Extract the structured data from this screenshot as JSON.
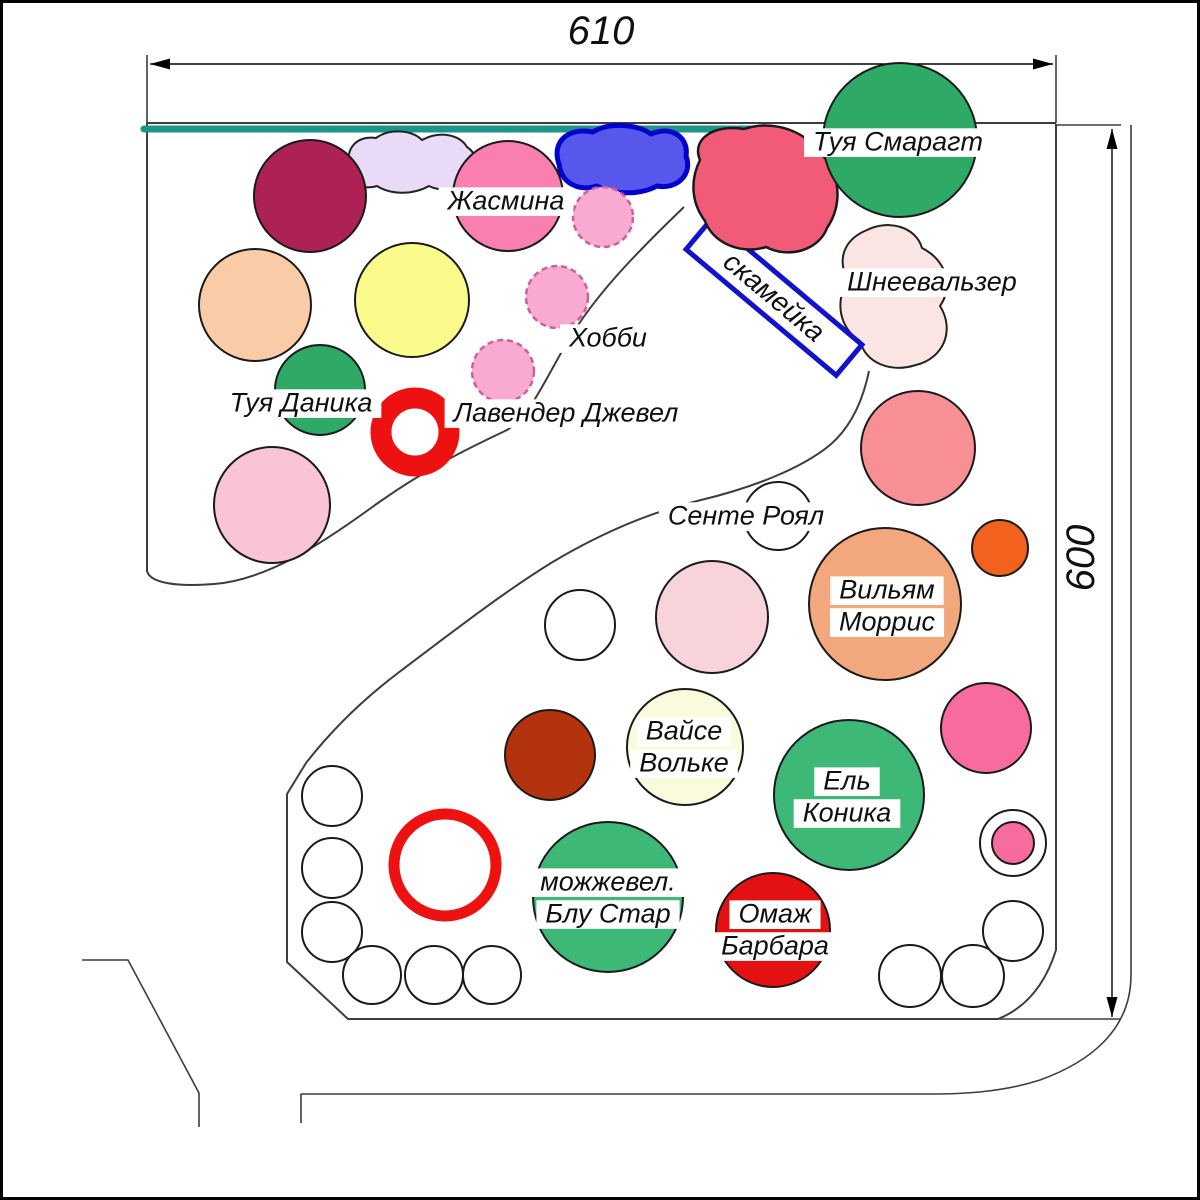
{
  "title": "Garden planting plan",
  "dim_top": {
    "label": "610",
    "line": {
      "x1": 150,
      "y1": 64,
      "x2": 1053,
      "y2": 64
    },
    "text_pos": {
      "x": 601,
      "y": 30
    },
    "rot": 0
  },
  "dim_right": {
    "label": "600",
    "line": {
      "x1": 1112,
      "y1": 129,
      "x2": 1112,
      "y2": 1017
    },
    "text_pos": {
      "x": 1080,
      "y": 558
    },
    "rot": -90
  },
  "aux_lines": [
    {
      "name": "extension-610-left",
      "d": "M147,55 V123"
    },
    {
      "name": "extension-610-right",
      "d": "M1056,55 V123"
    },
    {
      "name": "extension-600-top",
      "d": "M1057,125 H1121"
    },
    {
      "name": "extension-600-bottom",
      "d": "M995,1019 H1121"
    },
    {
      "name": "road-left",
      "d": "M82,960 H128 L199,1093 V1127"
    },
    {
      "name": "road-bottom-right",
      "d": "M1131,125 V975 C1131,1030 1090,1062 1040,1080 C1000,1093 958,1094 930,1094 H301 V1123"
    }
  ],
  "boundary": [
    {
      "name": "bed-upper-outline",
      "d": "M1056,123 H147 V571 C150,583 176,587 214,584 C266,580 320,545 371,508 C423,470 471,447 505,431 C529,419 544,381 568,341 C594,297 632,257 684,207"
    },
    {
      "name": "bed-lower-outline",
      "d": "M869,371 C863,400 851,427 830,445 C801,469 751,488 701,500 C650,512 601,533 551,563 C501,594 451,633 398,673 C361,701 331,731 306,763 L287,794 V962 L348,1019 H998 C1028,1007 1046,982 1056,950 V124"
    }
  ],
  "fence": {
    "name": "fence-teal",
    "d": "M144,129 H757",
    "color": "#1A968C",
    "width": 7
  },
  "blobs": [
    {
      "name": "lavender-blob",
      "layer": "under",
      "fill": "#E9DAF8",
      "stroke": "#222222",
      "sw": 2,
      "d": "M350,168 C344,149 357,135 376,138 C390,128 412,130 422,140 C440,130 460,135 467,147 C478,154 478,169 469,177 C461,190 441,192 429,186 C411,196 389,194 377,186 C361,191 352,182 350,168 Z"
    },
    {
      "name": "schneewalzer-blob",
      "layer": "under",
      "fill": "#FBE5E2",
      "stroke": "#222222",
      "sw": 2,
      "d": "M867,230 C889,219 916,227 922,248 C946,260 954,286 940,306 C955,330 944,358 916,365 C890,373 866,363 860,341 C840,329 834,301 848,281 C836,258 845,239 867,230 Z"
    },
    {
      "name": "red-blob",
      "layer": "over",
      "fill": "#F25B77",
      "stroke": "#1a1a1a",
      "sw": 2.5,
      "d": "M700,160 C691,139 714,124 744,129 C774,119 806,132 819,152 C841,172 843,205 827,228 C819,250 789,259 766,247 C741,255 713,243 705,221 C690,201 691,178 700,160 Z"
    },
    {
      "name": "blue-blob",
      "layer": "over",
      "fill": "#5757EB",
      "stroke": "#0202CF",
      "sw": 5,
      "d": "M559,164 C551,141 569,127 593,132 C609,122 637,124 651,134 C671,125 689,137 686,156 C693,174 677,190 657,186 C639,196 611,194 597,186 C577,192 561,182 559,164 Z"
    }
  ],
  "bench": {
    "label": "скамейка",
    "cx": 774,
    "cy": 297,
    "w": 196,
    "h": 40,
    "rot": 40,
    "stroke": "#1212CC",
    "sw": 5
  },
  "circles": [
    {
      "name": "maroon-shrub",
      "cx": 310,
      "cy": 196,
      "r": 56,
      "fill": "#AE2154"
    },
    {
      "name": "zhasmina-shrub",
      "cx": 508,
      "cy": 196,
      "r": 55,
      "fill": "#F97FB1"
    },
    {
      "name": "tuya-smaragd-circle",
      "cx": 900,
      "cy": 140,
      "r": 77,
      "fill": "#2FA966"
    },
    {
      "name": "hobby-shrub-1",
      "cx": 603,
      "cy": 217,
      "r": 30,
      "fill": "#F8AAD3",
      "dash": true
    },
    {
      "name": "peach-shrub",
      "cx": 255,
      "cy": 305,
      "r": 56,
      "fill": "#F9CCA7"
    },
    {
      "name": "yellow-shrub",
      "cx": 412,
      "cy": 300,
      "r": 57,
      "fill": "#FBFB8C"
    },
    {
      "name": "hobby-shrub-2",
      "cx": 557,
      "cy": 297,
      "r": 31,
      "fill": "#F8AAD3",
      "dash": true
    },
    {
      "name": "hobby-shrub-3",
      "cx": 503,
      "cy": 371,
      "r": 31,
      "fill": "#F8AAD3",
      "dash": true
    },
    {
      "name": "tuya-danika-circle",
      "cx": 320,
      "cy": 390,
      "r": 45,
      "fill": "#2FA966"
    },
    {
      "name": "red-ring-upper",
      "cx": 415,
      "cy": 432,
      "r": 34,
      "fill": "#FFFFFF",
      "stroke": "#EE1111",
      "sw": 21
    },
    {
      "name": "pink-shrub-left",
      "cx": 272,
      "cy": 505,
      "r": 58,
      "fill": "#F9C4D4"
    },
    {
      "name": "sente-royal-circle",
      "cx": 778,
      "cy": 516,
      "r": 34,
      "fill": "#FFFFFF"
    },
    {
      "name": "salmon-shrub",
      "cx": 918,
      "cy": 448,
      "r": 57,
      "fill": "#F78F95"
    },
    {
      "name": "orange-shrub",
      "cx": 1000,
      "cy": 548,
      "r": 28,
      "fill": "#F2621D"
    },
    {
      "name": "pale-pink-shrub",
      "cx": 712,
      "cy": 617,
      "r": 56,
      "fill": "#F8D3DC"
    },
    {
      "name": "william-morris-circle",
      "cx": 885,
      "cy": 604,
      "r": 76,
      "fill": "#F2A87C"
    },
    {
      "name": "white-shrub-mid",
      "cx": 580,
      "cy": 625,
      "r": 35,
      "fill": "#FFFFFF"
    },
    {
      "name": "hot-pink-shrub",
      "cx": 986,
      "cy": 728,
      "r": 45,
      "fill": "#F76B9F"
    },
    {
      "name": "brick-shrub",
      "cx": 550,
      "cy": 755,
      "r": 45,
      "fill": "#B2330E"
    },
    {
      "name": "weisse-wolke-circle",
      "cx": 685,
      "cy": 747,
      "r": 58,
      "fill": "#FAFADD"
    },
    {
      "name": "el-konika-circle",
      "cx": 849,
      "cy": 795,
      "r": 75,
      "fill": "#3DB877"
    },
    {
      "name": "red-ring-lower",
      "cx": 445,
      "cy": 865,
      "r": 51,
      "fill": "#FFFFFF",
      "stroke": "#EE1111",
      "sw": 11
    },
    {
      "name": "juniper-blue-star-circle",
      "cx": 608,
      "cy": 897,
      "r": 75,
      "fill": "#3DB877"
    },
    {
      "name": "ring-outer-white",
      "cx": 1013,
      "cy": 843,
      "r": 33,
      "fill": "#FFFFFF"
    },
    {
      "name": "ring-inner-pink",
      "cx": 1013,
      "cy": 843,
      "r": 21,
      "fill": "#F76B9F"
    },
    {
      "name": "homage-barbara-circle",
      "cx": 773,
      "cy": 930,
      "r": 57,
      "fill": "#E31111"
    },
    {
      "name": "white-shrub-bl-1",
      "cx": 332,
      "cy": 796,
      "r": 30,
      "fill": "#FFFFFF"
    },
    {
      "name": "white-shrub-bl-2",
      "cx": 332,
      "cy": 868,
      "r": 30,
      "fill": "#FFFFFF"
    },
    {
      "name": "white-shrub-bl-3",
      "cx": 332,
      "cy": 932,
      "r": 30,
      "fill": "#FFFFFF"
    },
    {
      "name": "white-shrub-bl-4",
      "cx": 372,
      "cy": 975,
      "r": 29,
      "fill": "#FFFFFF"
    },
    {
      "name": "white-shrub-bl-5",
      "cx": 434,
      "cy": 975,
      "r": 29,
      "fill": "#FFFFFF"
    },
    {
      "name": "white-shrub-bl-6",
      "cx": 492,
      "cy": 975,
      "r": 29,
      "fill": "#FFFFFF"
    },
    {
      "name": "white-shrub-br-1",
      "cx": 910,
      "cy": 976,
      "r": 31,
      "fill": "#FFFFFF"
    },
    {
      "name": "white-shrub-br-2",
      "cx": 973,
      "cy": 976,
      "r": 31,
      "fill": "#FFFFFF"
    },
    {
      "name": "white-shrub-br-3",
      "cx": 1013,
      "cy": 931,
      "r": 30,
      "fill": "#FFFFFF"
    }
  ],
  "labels": [
    {
      "name": "label-zhasmina",
      "text": "Жасмина",
      "x": 506,
      "y": 200,
      "size": 27,
      "bg": true
    },
    {
      "name": "label-hobby",
      "text": "Хобби",
      "x": 608,
      "y": 337,
      "size": 27,
      "bg": true
    },
    {
      "name": "label-lavender-jewel",
      "text": "Лавендер Джевел",
      "x": 566,
      "y": 412,
      "size": 27,
      "bg": true
    },
    {
      "name": "label-tuya-danika",
      "text": "Туя Даника",
      "x": 301,
      "y": 402,
      "size": 27,
      "bg": true
    },
    {
      "name": "label-tuya-smaragd",
      "text": "Туя Смарагт",
      "x": 898,
      "y": 141,
      "size": 27,
      "bg": true
    },
    {
      "name": "label-schneewalzer",
      "text": "Шнеевальзер",
      "x": 932,
      "y": 281,
      "size": 27,
      "bg": true
    },
    {
      "name": "label-sente-royal",
      "text": "Сенте Роял",
      "x": 746,
      "y": 515,
      "size": 27,
      "bg": true
    },
    {
      "name": "label-william-morris",
      "text": [
        "Вильям",
        "Моррис"
      ],
      "x": 887,
      "y": 605,
      "size": 27,
      "bg": true
    },
    {
      "name": "label-weisse-wolke",
      "text": [
        "Вайсе",
        "Вольке"
      ],
      "x": 684,
      "y": 746,
      "size": 27,
      "bg": true
    },
    {
      "name": "label-el-konika",
      "text": [
        "Ель",
        "Коника"
      ],
      "x": 847,
      "y": 796,
      "size": 27,
      "bg": true
    },
    {
      "name": "label-juniper-blue-star",
      "text": [
        "можжевел.",
        "Блу Стар"
      ],
      "x": 608,
      "y": 897,
      "size": 27,
      "bg": true
    },
    {
      "name": "label-homage-barbara",
      "text": [
        "Омаж",
        "Барбара"
      ],
      "x": 775,
      "y": 929,
      "size": 27,
      "bg": true
    }
  ]
}
